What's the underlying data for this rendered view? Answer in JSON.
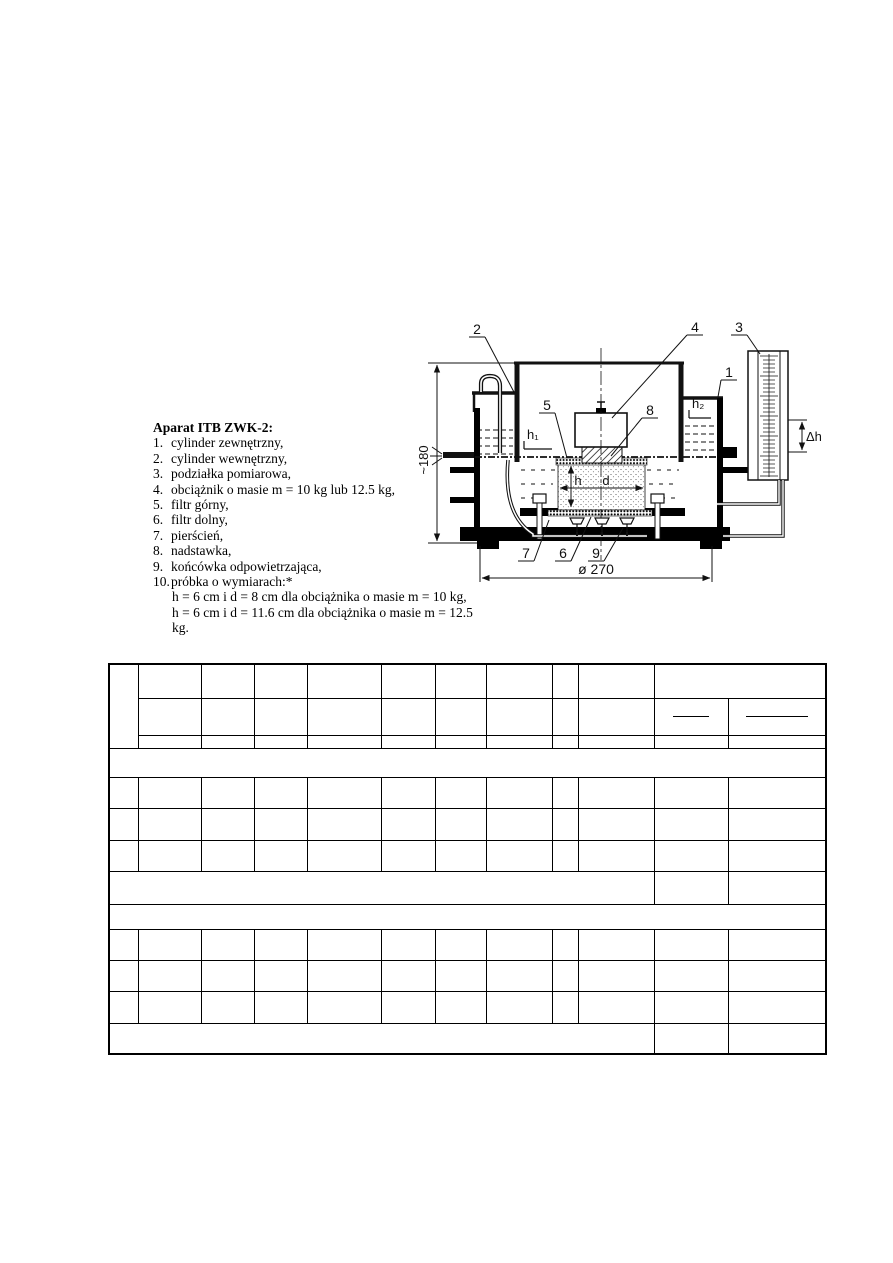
{
  "apparatus": {
    "title": "Aparat ITB ZWK-2:",
    "items": [
      {
        "num": "1.",
        "text": "cylinder zewnętrzny,"
      },
      {
        "num": "2.",
        "text": "cylinder wewnętrzny,"
      },
      {
        "num": "3.",
        "text": "podziałka pomiarowa,"
      },
      {
        "num": "4.",
        "text": "obciążnik o masie m = 10 kg lub 12.5 kg,"
      },
      {
        "num": "5.",
        "text": "filtr górny,"
      },
      {
        "num": "6.",
        "text": "filtr dolny,"
      },
      {
        "num": "7.",
        "text": "pierścień,"
      },
      {
        "num": "8.",
        "text": "nadstawka,"
      },
      {
        "num": "9.",
        "text": "końcówka odpowietrzająca,"
      },
      {
        "num": "10.",
        "text": "próbka o wymiarach:*"
      }
    ],
    "footnotes": [
      "h = 6 cm i d = 8 cm dla obciążnika o masie m = 10 kg,",
      "h = 6 cm i d = 11.6 cm dla obciążnika o masie m = 12.5 kg."
    ]
  },
  "diagram": {
    "labels": {
      "n1": "1",
      "n2": "2",
      "n3": "3",
      "n4": "4",
      "n5": "5",
      "n6": "6",
      "n7": "7",
      "n8": "8",
      "n9": "9"
    },
    "dims": {
      "height": "~180",
      "diameter": "ø 270",
      "h1": "h₁",
      "h2": "h₂",
      "dh": "Δh",
      "h": "h",
      "d": "d"
    }
  },
  "table": {
    "content": "blank form, all cells empty",
    "header_fraction_bars": 2
  }
}
